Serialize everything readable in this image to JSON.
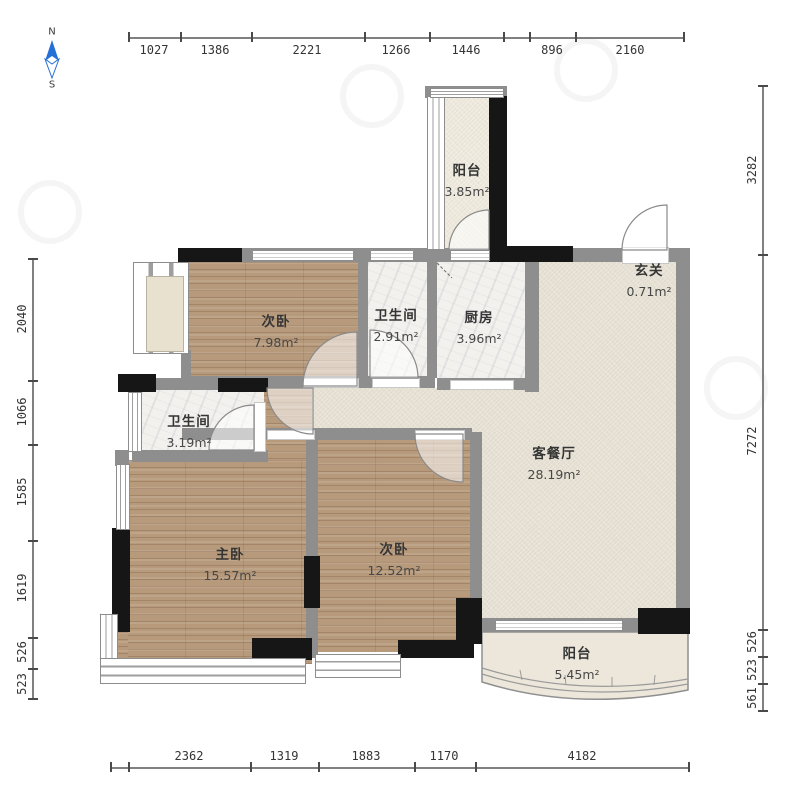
{
  "compass": {
    "north": "N",
    "south": "S"
  },
  "dimensions": {
    "top": [
      "1027",
      "1386",
      "2221",
      "1266",
      "1446",
      "896",
      "2160"
    ],
    "bottom": [
      "2362",
      "1319",
      "1883",
      "1170",
      "4182"
    ],
    "left": [
      "2040",
      "1066",
      "1585",
      "1619",
      "526",
      "523"
    ],
    "right": [
      "3282",
      "7272",
      "526",
      "523",
      "561"
    ]
  },
  "rooms": [
    {
      "name": "阳台",
      "area": "3.85m²"
    },
    {
      "name": "次卧",
      "area": "7.98m²"
    },
    {
      "name": "卫生间",
      "area": "2.91m²"
    },
    {
      "name": "厨房",
      "area": "3.96m²"
    },
    {
      "name": "玄关",
      "area": "0.71m²"
    },
    {
      "name": "卫生间",
      "area": "3.19m²"
    },
    {
      "name": "主卧",
      "area": "15.57m²"
    },
    {
      "name": "次卧",
      "area": "12.52m²"
    },
    {
      "name": "客餐厅",
      "area": "28.19m²"
    },
    {
      "name": "阳台",
      "area": "5.45m²"
    }
  ],
  "colors": {
    "wood_floor": "#b79a7c",
    "tile_floor": "#f2f1ee",
    "living_floor": "#e7e2d5",
    "balcony_floor": "#efeade",
    "wall_gray": "#8e8e8e",
    "wall_black": "#161616",
    "compass_blue": "#2570d6"
  }
}
